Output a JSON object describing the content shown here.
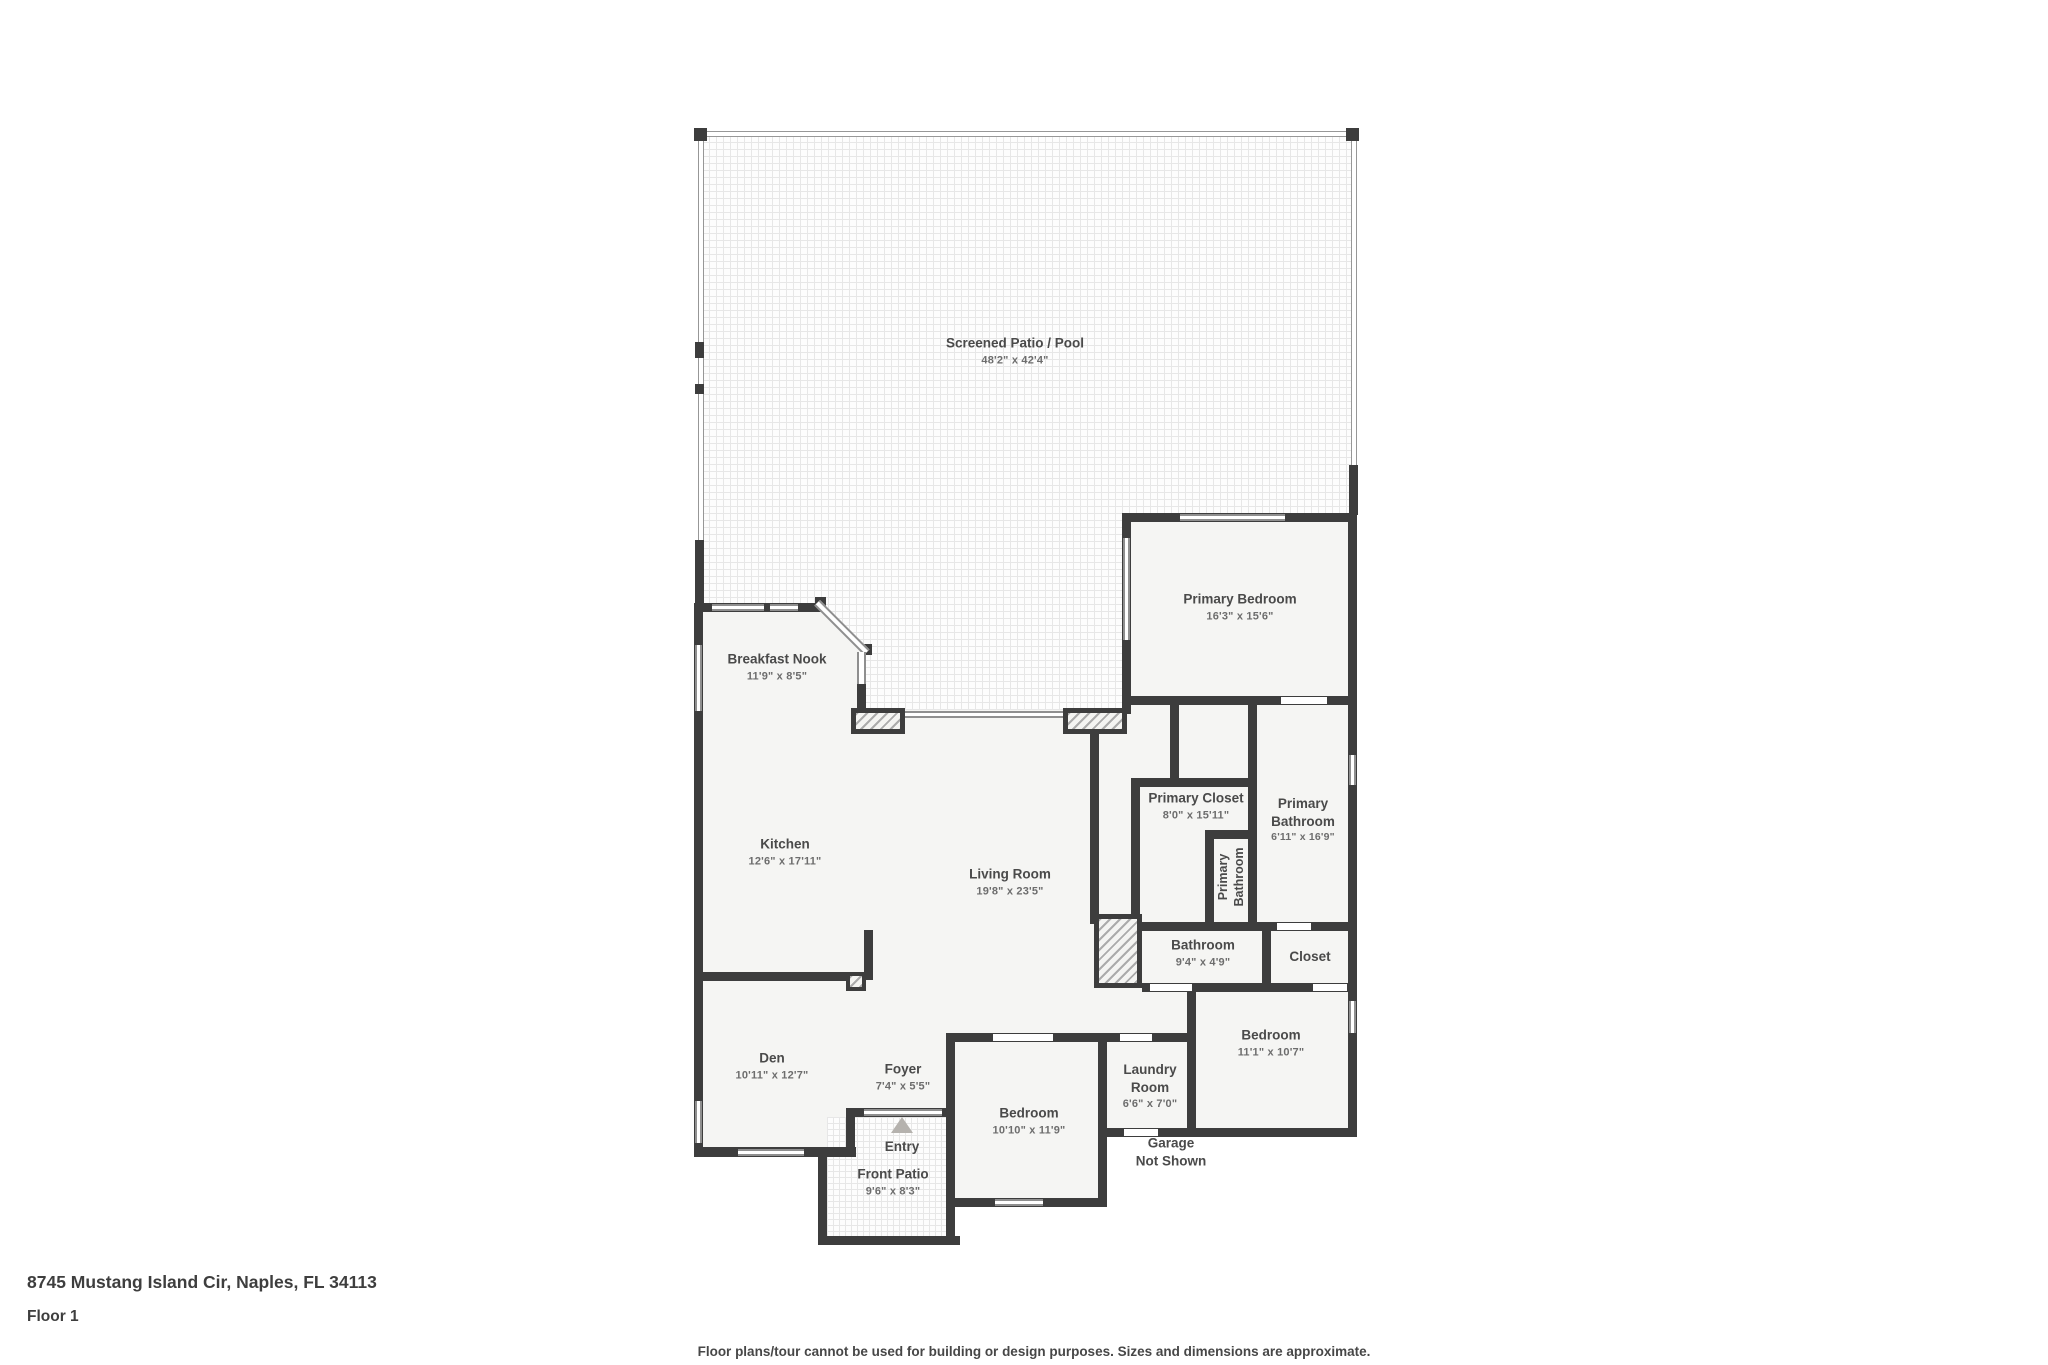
{
  "rooms": {
    "screened_patio": {
      "name": "Screened Patio / Pool",
      "dims": "48'2\" x 42'4\""
    },
    "primary_bedroom": {
      "name": "Primary Bedroom",
      "dims": "16'3\" x 15'6\""
    },
    "breakfast_nook": {
      "name": "Breakfast Nook",
      "dims": "11'9\" x 8'5\""
    },
    "kitchen": {
      "name": "Kitchen",
      "dims": "12'6\" x 17'11\""
    },
    "living_room": {
      "name": "Living Room",
      "dims": "19'8\" x 23'5\""
    },
    "primary_closet": {
      "name": "Primary Closet",
      "dims": "8'0\" x 15'11\""
    },
    "primary_bathroom_small": {
      "name": "Primary Bathroom"
    },
    "primary_bathroom": {
      "name": "Primary Bathroom",
      "dims": "6'11\" x 16'9\""
    },
    "bathroom": {
      "name": "Bathroom",
      "dims": "9'4\" x 4'9\""
    },
    "closet": {
      "name": "Closet"
    },
    "den": {
      "name": "Den",
      "dims": "10'11\" x 12'7\""
    },
    "foyer": {
      "name": "Foyer",
      "dims": "7'4\" x 5'5\""
    },
    "entry": {
      "name": "Entry"
    },
    "front_patio": {
      "name": "Front Patio",
      "dims": "9'6\" x 8'3\""
    },
    "bedroom_bottom": {
      "name": "Bedroom",
      "dims": "10'10\" x 11'9\""
    },
    "laundry_room": {
      "name": "Laundry Room",
      "dims": "6'6\" x 7'0\""
    },
    "garage": {
      "name": "Garage",
      "note": "Not Shown"
    },
    "bedroom_right": {
      "name": "Bedroom",
      "dims": "11'1\" x 10'7\""
    }
  },
  "footer": {
    "address": "8745 Mustang Island Cir, Naples, FL 34113",
    "floor_label": "Floor 1",
    "disclaimer": "Floor plans/tour cannot be used for building or design purposes. Sizes and dimensions are approximate."
  },
  "colors": {
    "wall": "#3d3d3d",
    "room_fill": "#f5f5f3",
    "label_text": "#4a4a4a",
    "dims_text": "#6d6d6d",
    "screen_line": "#979797",
    "entry_marker": "#b5b2ae"
  }
}
